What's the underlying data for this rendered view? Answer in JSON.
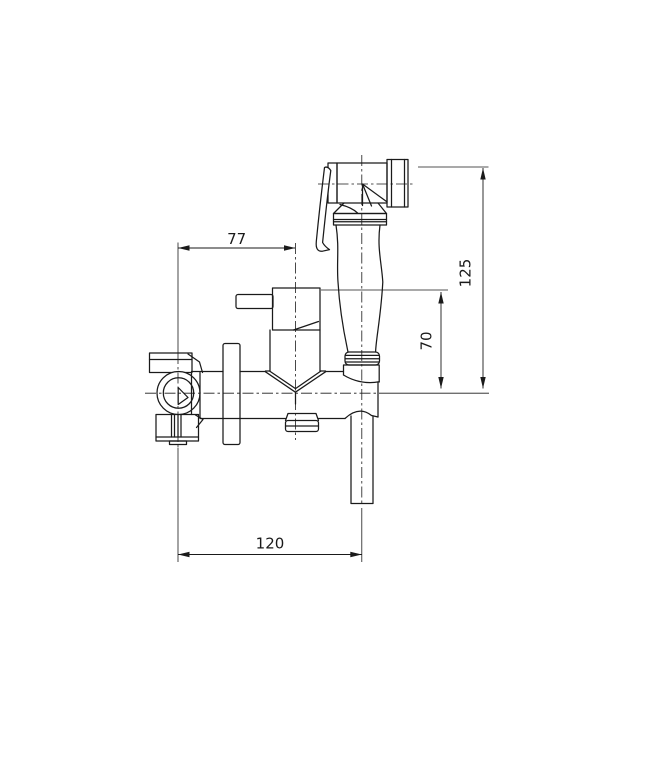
{
  "drawing": {
    "kind": "technical-dimension-drawing",
    "subject": "wall-mounted-bidet-shower-mixer-side-view",
    "dimensions": {
      "width_77": "77",
      "height_125": "125",
      "height_70": "70",
      "width_120": "120"
    },
    "colors": {
      "line": "#1a1a1a",
      "background": "#ffffff"
    }
  }
}
